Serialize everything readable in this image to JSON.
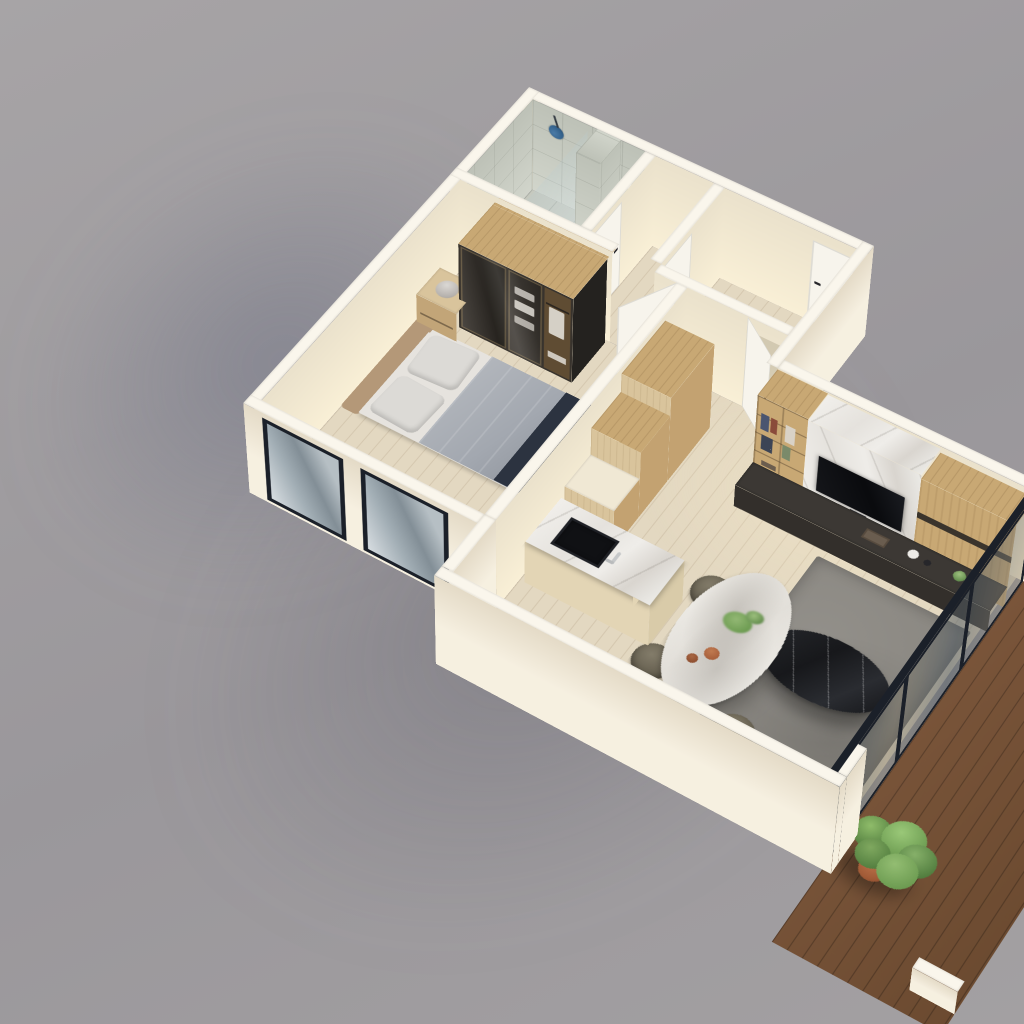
{
  "scene": {
    "title": "3D apartment floor plan render",
    "view": "isometric cutaway, viewed from above on gray studio backdrop",
    "rooms_label": "One-bedroom apartment"
  },
  "colors": {
    "bg1": "#a7a4a6",
    "bg2": "#9a979b",
    "bg3": "#a3a0a2",
    "wallTop": "#faf6ec",
    "wallBright": "#f5eedd",
    "wallLit": "#f6eed9",
    "floorWood": "#e3d8c1",
    "tile": "#c6c9bf",
    "tileWall": "#ccd0c5",
    "deckWood": "#7a553a",
    "frameDark": "#1b2029",
    "doorWhite": "#f7f4ec",
    "handle": "#26262a",
    "wardrobeGlass": "#38332d",
    "woodTop": "#c8a874",
    "woodCab": "#d9c49c",
    "marbleWhite": "#ecebe7",
    "tvBlack": "#0e0f12",
    "consoleDark": "#3c3834",
    "rugGray": "#8a8781",
    "coffeeBlack": "#1b1d21",
    "sofaWood": "#c59e73",
    "cushion": "#e9e5da",
    "duvet": "#a3a8b0",
    "pillow": "#dcdad6",
    "headboard": "#b49878",
    "bedRunner": "#2c3340",
    "chairOlive": "#6e6857",
    "tableWhite": "#eceae5",
    "islandWood": "#e3d5b5",
    "sinkBlack": "#101114",
    "accentBlue": "#34628c",
    "plantGreen": "#6b9a50",
    "plantDeep": "#4e7a3c",
    "potClay": "#a05a36",
    "matGray": "#9b9891",
    "lampGray": "#b5b1ad",
    "clothes": "#eae7e1"
  },
  "rooms": {
    "bedroom": {
      "label": "Bedroom with double bed, wardrobe, nightstand and two black-framed windows"
    },
    "bathroom": {
      "label": "Tiled bathroom with walk-in shower, blue rain shower head and toilet"
    },
    "hallway": {
      "label": "Hallway with white doors"
    },
    "entry": {
      "label": "Entry hall with recessed front door"
    },
    "kitchen": {
      "label": "Kitchen with tall oak cabinets and marble island with black sink"
    },
    "dining": {
      "label": "Dining area with oval marble table and four olive chairs"
    },
    "living": {
      "label": "Living room with marble TV wall, bookshelf, rug and black marble coffee table"
    },
    "balcony": {
      "label": "Balcony terrace with dark wood decking, potted plant and sliding glass door"
    }
  },
  "furniture": {
    "bed": {
      "label": "Double bed with tan headboard, gray duvet and dark runner"
    },
    "wardrobe": {
      "label": "Smoked-glass wardrobe with oak top and clothes inside"
    },
    "nightstand": {
      "label": "Oak nightstand with gray sphere lamp and small plant"
    },
    "island": {
      "label": "Kitchen island with marble top, black sink and chrome faucet"
    },
    "dining_table": {
      "label": "Oval white marble dining table with greenery and rust vases"
    },
    "tv_wall": {
      "label": "Marble media wall with black TV, wood panel and book shelving"
    },
    "coffee_table": {
      "label": "Black marble oval coffee table"
    },
    "sofa": {
      "label": "Sofa with wood frame and cream cushions behind front wall"
    },
    "rug": {
      "label": "Gray area rug"
    },
    "plant": {
      "label": "Potted green plant in terracotta pot"
    },
    "toilet": {
      "label": "White toilet"
    },
    "shower": {
      "label": "Walk-in shower with glass screen and blue shower head"
    }
  }
}
